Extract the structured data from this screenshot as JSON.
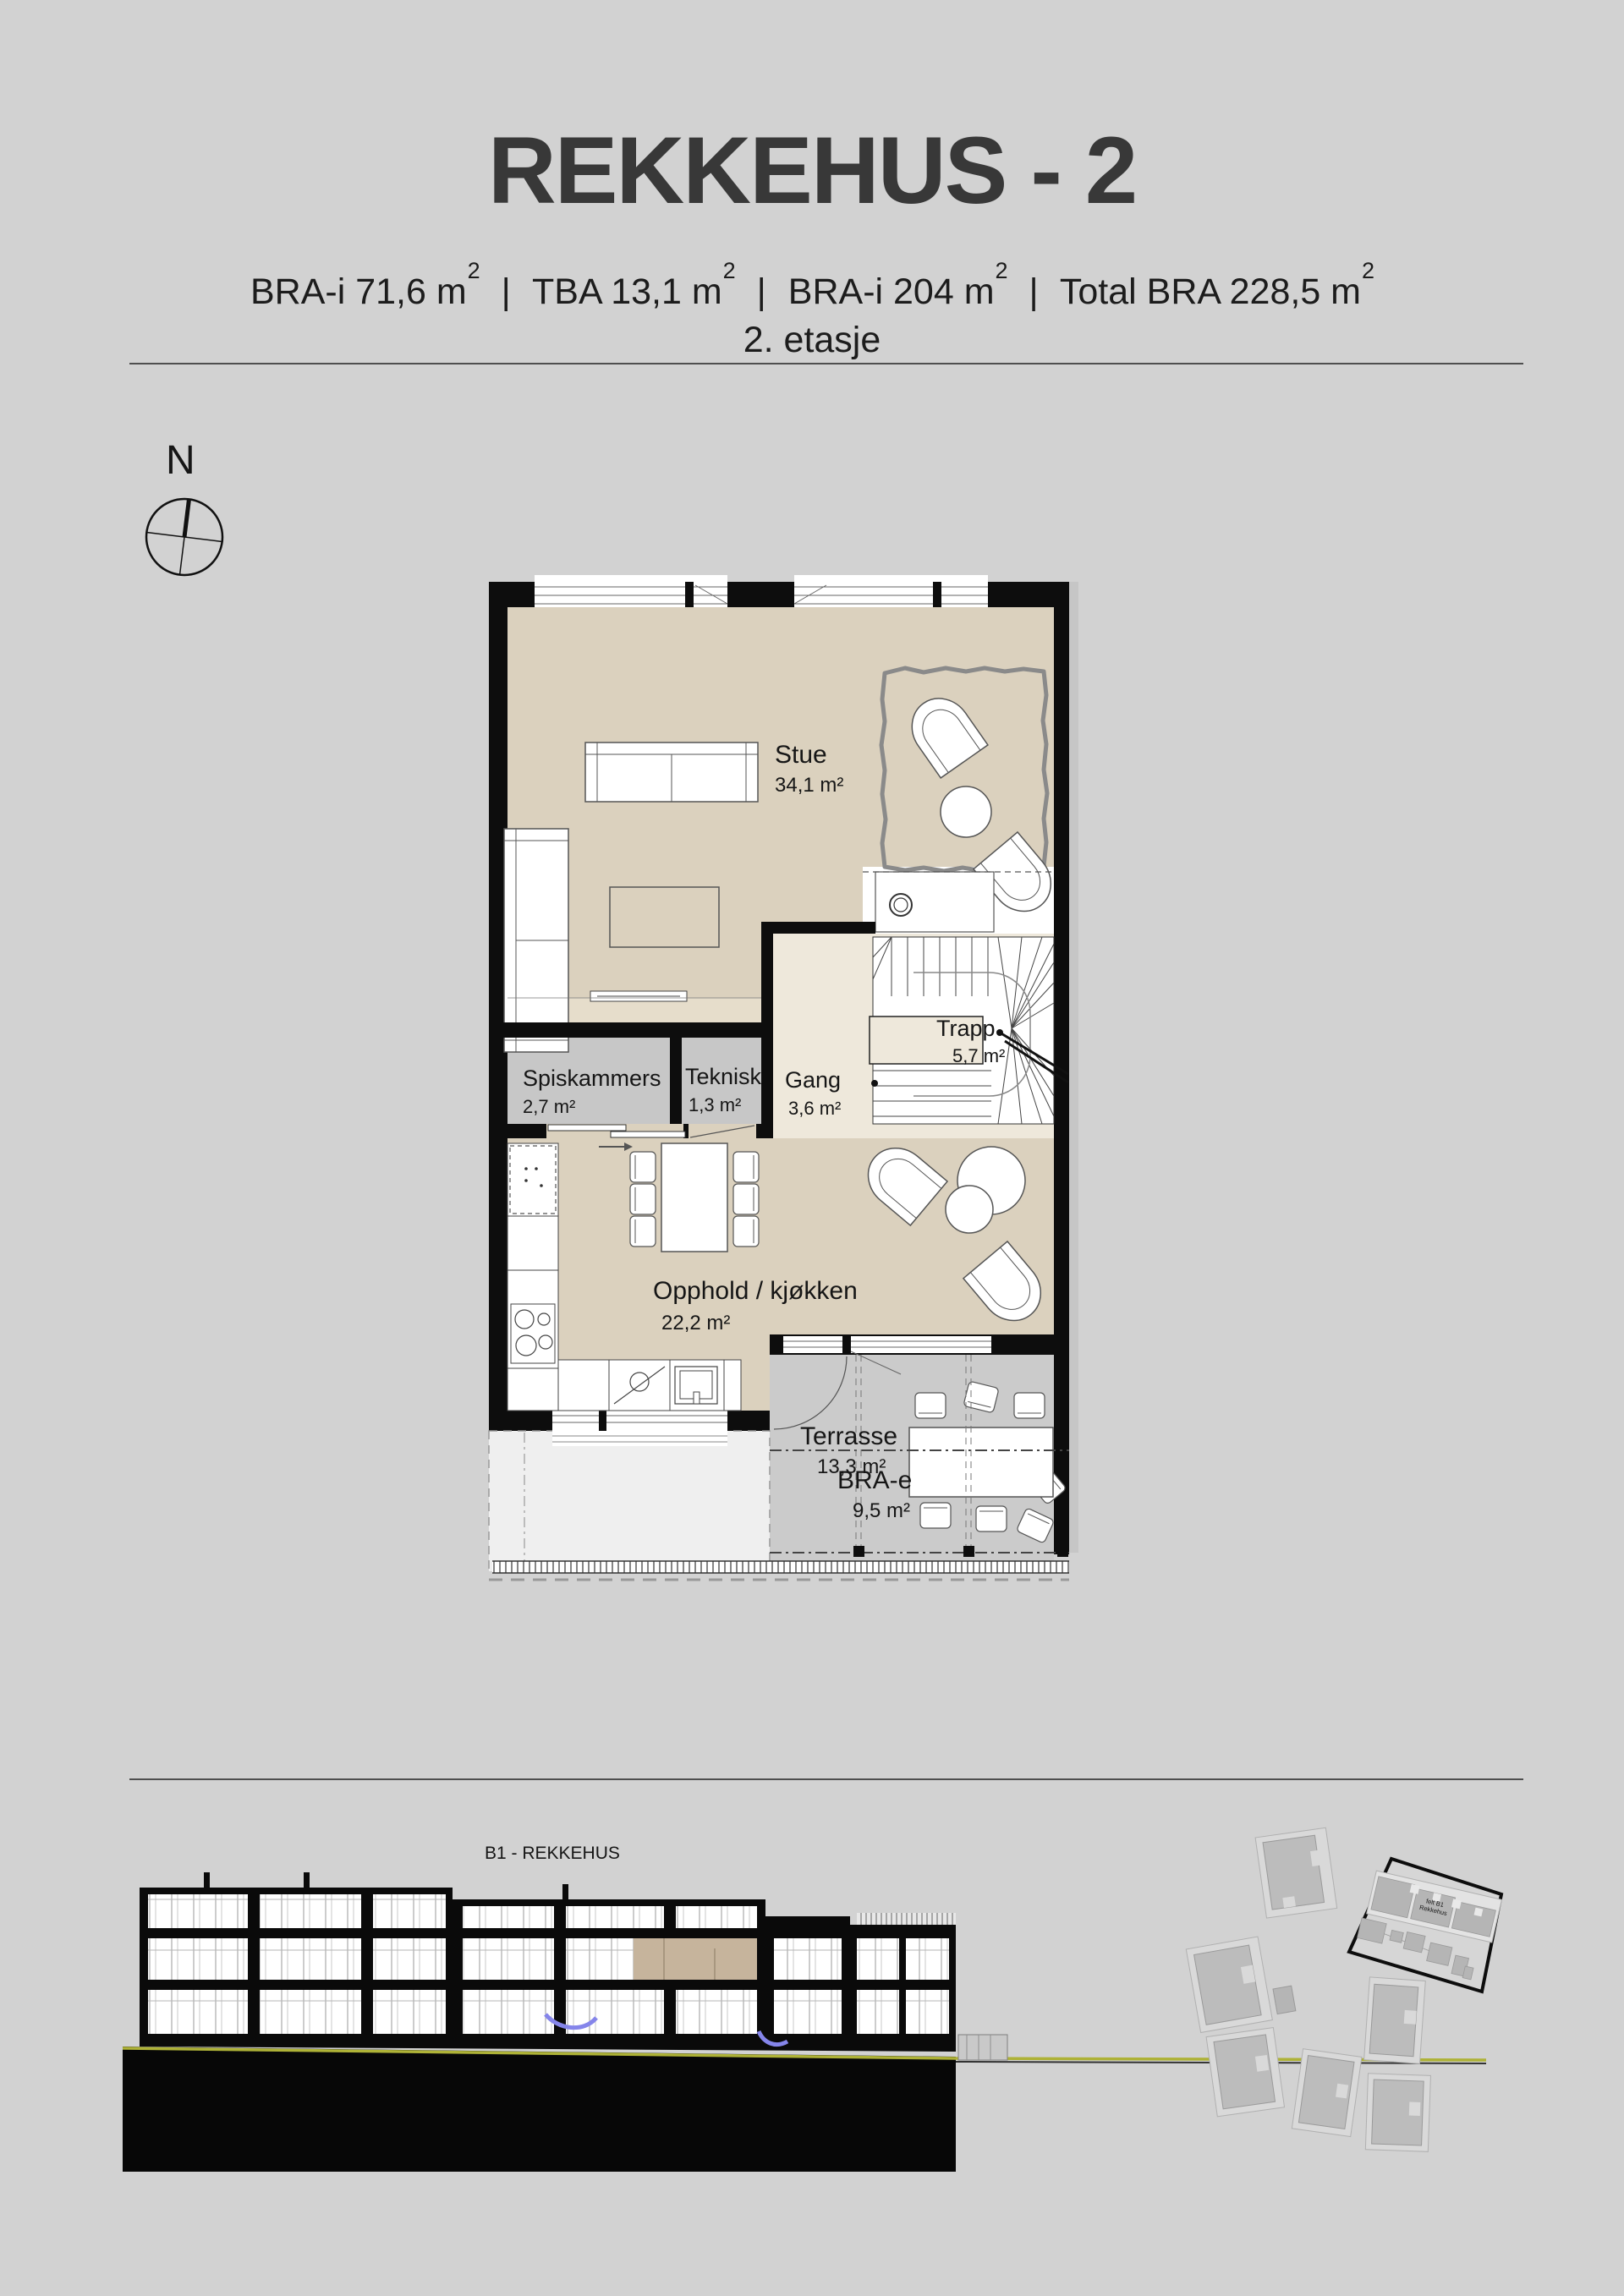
{
  "page": {
    "background": "#d2d2d2"
  },
  "header": {
    "title": "REKKEHUS - 2",
    "area_segments": [
      {
        "pre": "BRA-i 71,6 m",
        "sup": "2"
      },
      {
        "pre": "TBA 13,1 m",
        "sup": "2"
      },
      {
        "pre": "BRA-i 204 m",
        "sup": "2"
      },
      {
        "pre": "Total BRA 228,5 m",
        "sup": "2"
      }
    ],
    "separator": "|",
    "floor_label": "2. etasje"
  },
  "compass": {
    "label": "N"
  },
  "floor_plan": {
    "rooms": [
      {
        "name": "Stue",
        "area": "34,1 m²"
      },
      {
        "name": "Trapp",
        "area": "5,7 m²"
      },
      {
        "name": "Spiskammers",
        "area": "2,7 m²"
      },
      {
        "name": "Teknisk",
        "area": "1,3 m²"
      },
      {
        "name": "Gang",
        "area": "3,6 m²"
      },
      {
        "name": "Opphold / kjøkken",
        "area": "22,2 m²"
      },
      {
        "name": "Terrasse",
        "area": "13,3 m²"
      },
      {
        "name": "BRA-e",
        "area": "9,5 m²"
      }
    ]
  },
  "section": {
    "label": "B1 - REKKEHUS"
  },
  "site_plan": {
    "parcel_label": [
      "felt B1",
      "Rekkehus"
    ]
  },
  "colors": {
    "floor_beige": "#dbd1be",
    "floor_light": "#eee8db",
    "floor_strip": "#e6ddcb",
    "floor_gray": "#c7c7c7",
    "terrace_gray": "#cbcbcb",
    "wall_black": "#0d0d0d",
    "rug_gray": "#8a8a8a",
    "terrain_yellow": "#aeb237",
    "stair_blue": "#8585ea",
    "section_room_beige": "#c6b49c"
  }
}
